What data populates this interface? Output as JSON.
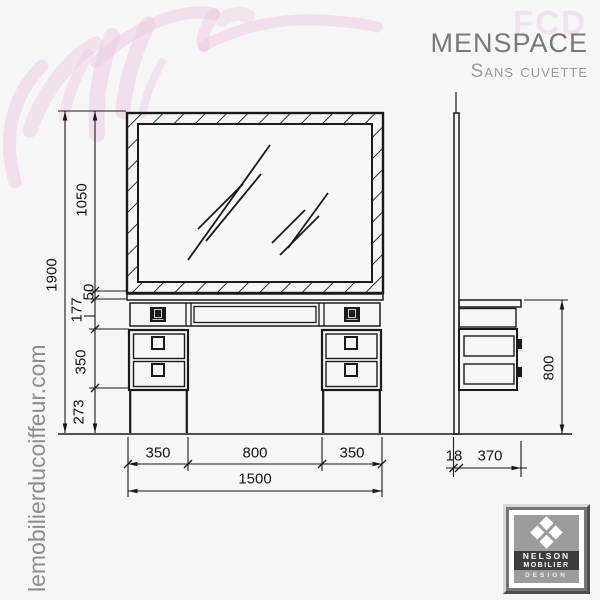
{
  "branding": {
    "watermark": "FCD",
    "title": "MENSPACE",
    "subtitle": "Sans cuvette",
    "website": "lemobilierducoiffeur.com",
    "logo": {
      "line1": "NELSON",
      "line2": "MOBILIER",
      "line3": "DESIGN"
    }
  },
  "dims": {
    "total_height": "1900",
    "mirror_height": "1050",
    "counter_thickness": "50",
    "apron_height": "177",
    "drawer_unit_height": "350",
    "base_clearance": "273",
    "left_unit_width": "350",
    "knee_space_width": "800",
    "right_unit_width": "350",
    "total_width": "1500",
    "worktop_height": "800",
    "panel_thickness": "18",
    "worktop_depth": "370"
  },
  "colors": {
    "background": "#f6f6f6",
    "line": "#1a1a1a",
    "accent_pink": "#ecc9df",
    "title_gray": "#7b767a",
    "subtitle_gray": "#9d989c",
    "website_gray": "#8d8d8d",
    "watermark_pink": "#ede4ee"
  }
}
